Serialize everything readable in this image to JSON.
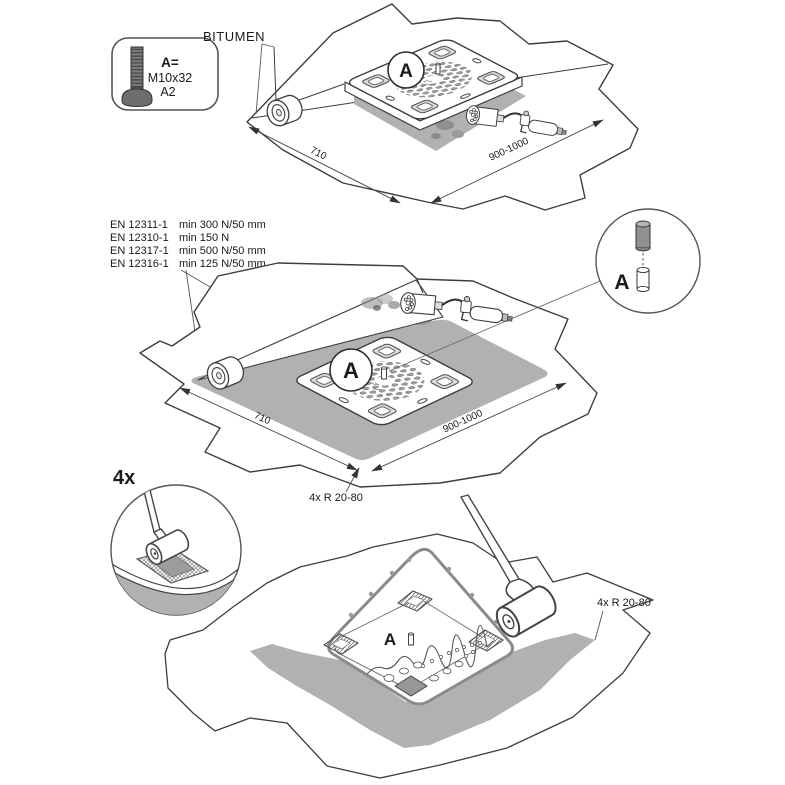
{
  "colors": {
    "line": "#3d3d3d",
    "thin_line": "#555555",
    "membrane_gray": "#b1b1b1",
    "plate_edge_gray": "#8a8a8a",
    "corner_hole_gray": "#979797",
    "background": "#ffffff"
  },
  "legend": {
    "icon": "carriage-bolt-icon",
    "label": "A=",
    "size": "M10x32",
    "material": "A2"
  },
  "bitumen_label": "BITUMEN",
  "standards": [
    {
      "code": "EN 12311-1",
      "value": "min 300 N/50 mm"
    },
    {
      "code": "EN 12310-1",
      "value": "min 150 N"
    },
    {
      "code": "EN 12317-1",
      "value": "min 500 N/50 mm"
    },
    {
      "code": "EN 12316-1",
      "value": "min 125 N/50 mm"
    }
  ],
  "step1": {
    "marker": "A",
    "dim_width": "710",
    "dim_length": "900-1000"
  },
  "step2": {
    "marker": "A",
    "dim_width": "710",
    "dim_length": "900-1000",
    "corner_radius_note": "4x R 20-80"
  },
  "bolt_detail": {
    "marker": "A"
  },
  "roller_detail": {
    "count_note": "4x"
  },
  "step3": {
    "marker": "A",
    "corner_radius_note": "4x R 20-80"
  }
}
